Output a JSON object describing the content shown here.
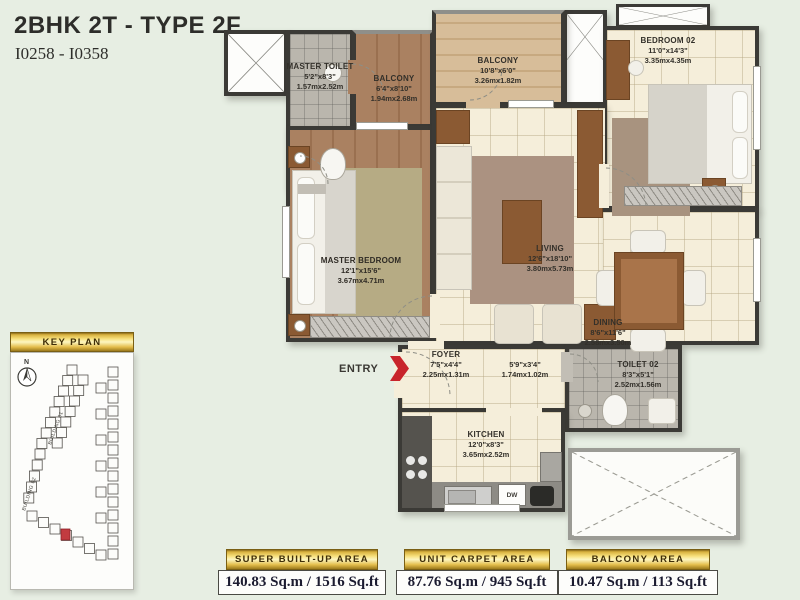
{
  "title": {
    "main": "2BHK 2T - TYPE 2F",
    "code": "I0258 - I0358"
  },
  "entry": {
    "label": "ENTRY"
  },
  "keyplan": {
    "header": "KEY PLAN",
    "north_label": "N",
    "building_labels": {
      "b1": "BUILDING 01",
      "b2": "BUILDING 02"
    }
  },
  "rooms": {
    "master_toilet": {
      "name": "MASTER TOILET",
      "dims_ft": "5'2\"x8'3\"",
      "dims_m": "1.57mx2.52m"
    },
    "balcony_1": {
      "name": "BALCONY",
      "dims_ft": "6'4\"x8'10\"",
      "dims_m": "1.94mx2.68m"
    },
    "balcony_2": {
      "name": "BALCONY",
      "dims_ft": "10'8\"x6'0\"",
      "dims_m": "3.26mx1.82m"
    },
    "bedroom_02": {
      "name": "BEDROOM 02",
      "dims_ft": "11'0\"x14'3\"",
      "dims_m": "3.35mx4.35m"
    },
    "master_bedroom": {
      "name": "MASTER BEDROOM",
      "dims_ft": "12'1\"x15'6\"",
      "dims_m": "3.67mx4.71m"
    },
    "living": {
      "name": "LIVING",
      "dims_ft": "12'6\"x18'10\"",
      "dims_m": "3.80mx5.73m"
    },
    "dining": {
      "name": "DINING",
      "dims_ft": "8'6\"x11'6\"",
      "dims_m": "2.58mx3.50m"
    },
    "foyer": {
      "name": "FOYER",
      "dims_ft": "7'5\"x4'4\"",
      "dims_m": "2.25mx1.31m"
    },
    "passage": {
      "name": "",
      "dims_ft": "5'9\"x3'4\"",
      "dims_m": "1.74mx1.02m"
    },
    "toilet_02": {
      "name": "TOILET 02",
      "dims_ft": "8'3\"x5'1\"",
      "dims_m": "2.52mx1.56m"
    },
    "kitchen": {
      "name": "KITCHEN",
      "dims_ft": "12'0\"x8'3\"",
      "dims_m": "3.65mx2.52m"
    }
  },
  "labels": {
    "dishwasher": "DW"
  },
  "areas": [
    {
      "header": "SUPER BUILT-UP AREA",
      "value": "140.83 Sq.m / 1516 Sq.ft"
    },
    {
      "header": "UNIT CARPET AREA",
      "value": "87.76 Sq.m / 945 Sq.ft"
    },
    {
      "header": "BALCONY AREA",
      "value": "10.47 Sq.m / 113 Sq.ft"
    }
  ],
  "colors": {
    "background": "#e7eee3",
    "wall": "#3b3a36",
    "gold": "#e3bc4a",
    "entry_arrow": "#c8242b",
    "highlight_unit": "#c23b40"
  }
}
